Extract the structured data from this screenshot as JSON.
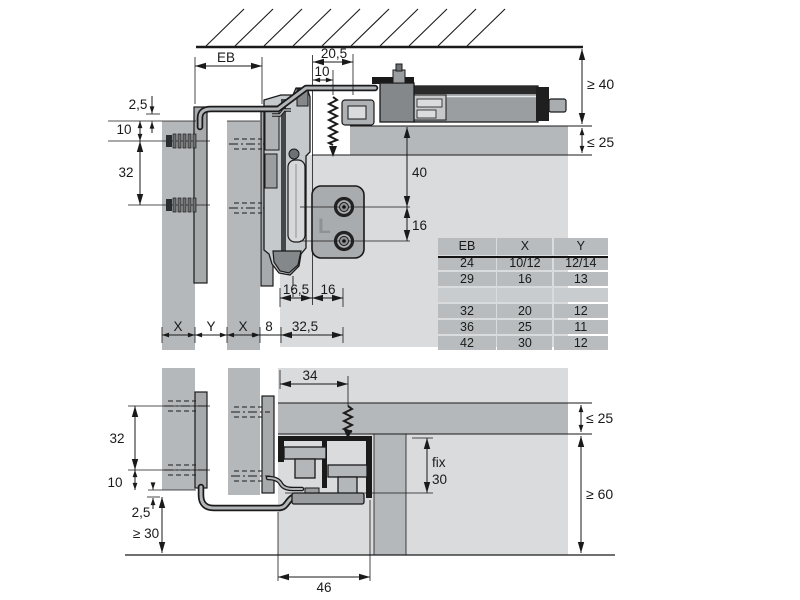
{
  "upper": {
    "dims": {
      "eb": "EB",
      "d20_5": "20,5",
      "d10_track": "10",
      "min40": "≥ 40",
      "max25": "≤ 25",
      "d2_5": "2,5",
      "d10_side": "10",
      "d32": "32",
      "d40": "40",
      "d16": "16",
      "d16_5": "16,5",
      "d16r": "16",
      "x1": "X",
      "y1": "Y",
      "x2": "X",
      "d8": "8",
      "d32_5": "32,5"
    },
    "plate_mark": "L"
  },
  "lower": {
    "dims": {
      "d34": "34",
      "max25": "≤ 25",
      "d32": "32",
      "d10": "10",
      "fix": "fix",
      "d30": "30",
      "d2_5": "2,5",
      "min30": "≥ 30",
      "min60": "≥ 60",
      "d46": "46"
    }
  },
  "table": {
    "headers": [
      "EB",
      "X",
      "Y"
    ],
    "rows": [
      [
        "24",
        "10/12",
        "12/14"
      ],
      [
        "29",
        "16",
        "13"
      ],
      [
        "",
        "",
        ""
      ],
      [
        "32",
        "20",
        "12"
      ],
      [
        "36",
        "25",
        "11"
      ],
      [
        "42",
        "30",
        "12"
      ]
    ]
  },
  "colors": {
    "outline": "#1a1a1a",
    "panel_gray": "#b5b8bb",
    "interior_gray": "#d9dbdd",
    "plate_gray": "#a7aaad",
    "track_gray": "#9b9ea1",
    "hardware_light": "#c6c9cc",
    "hardware_dark": "#85888b",
    "table_cell": "#b9bcbe",
    "table_empty_row": "#c9ccce",
    "background": "#ffffff"
  }
}
